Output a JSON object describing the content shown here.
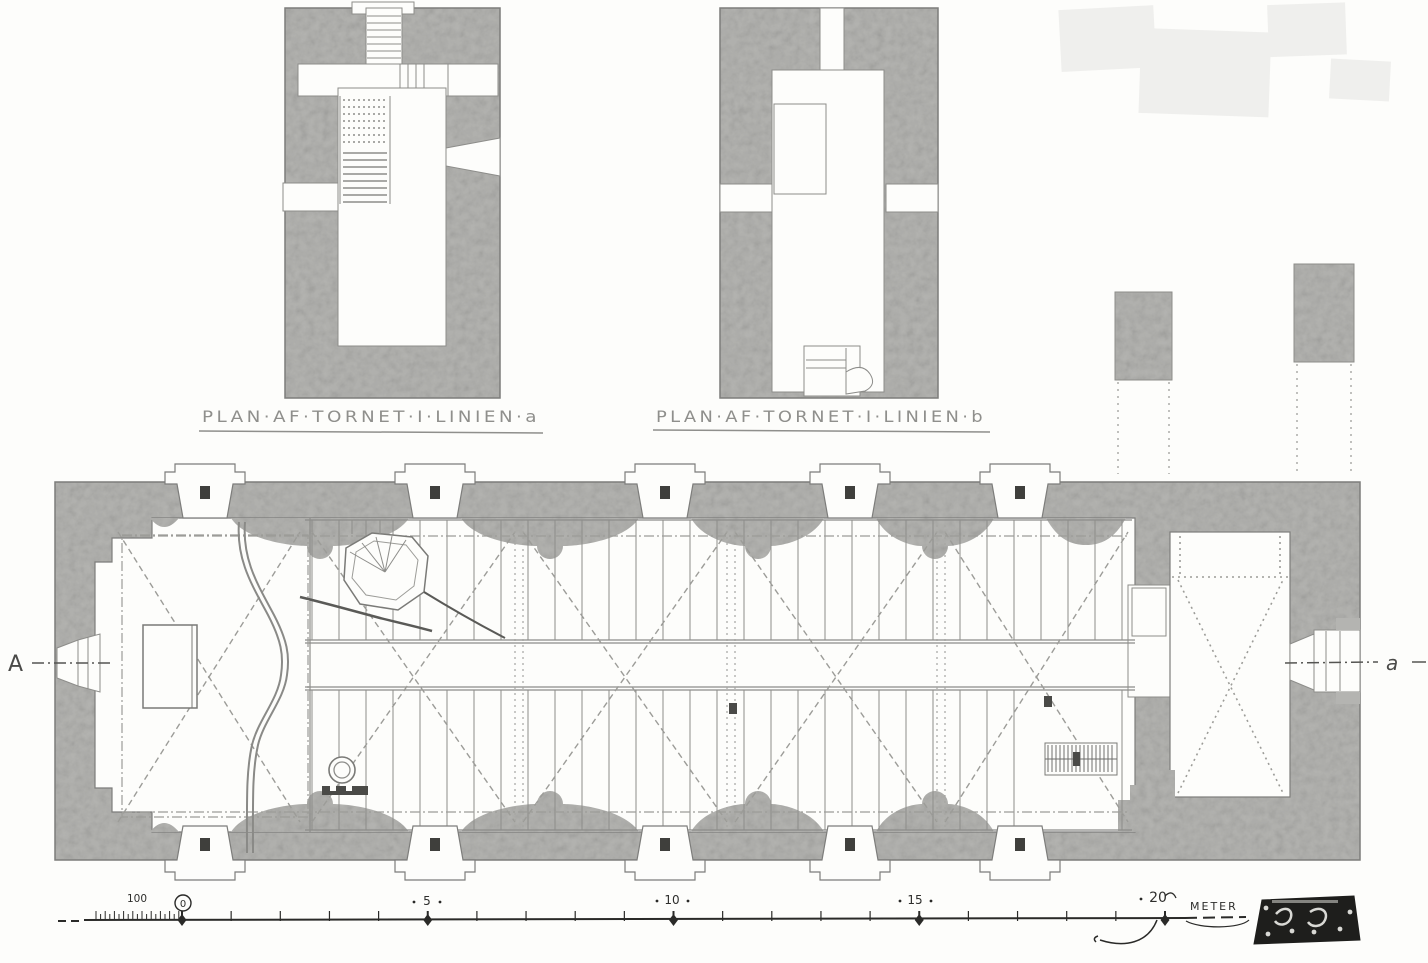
{
  "figures": {
    "tower_plan_a": {
      "caption": "PLAN·AF·TORNET·I·LINIEN·a"
    },
    "tower_plan_b": {
      "caption": "PLAN·AF·TORNET·I·LINIEN·b"
    }
  },
  "section_markers": {
    "left": "A",
    "right": "a"
  },
  "scale_bar": {
    "subdivision_label": "100",
    "ticks": [
      "0",
      "5",
      "10",
      "15",
      "20"
    ],
    "unit_label": "METER"
  },
  "palette": {
    "wall_gray": "#b4b4b1",
    "paper": "#fdfdfb",
    "line": "#7d7d7b",
    "ink": "#232321"
  }
}
